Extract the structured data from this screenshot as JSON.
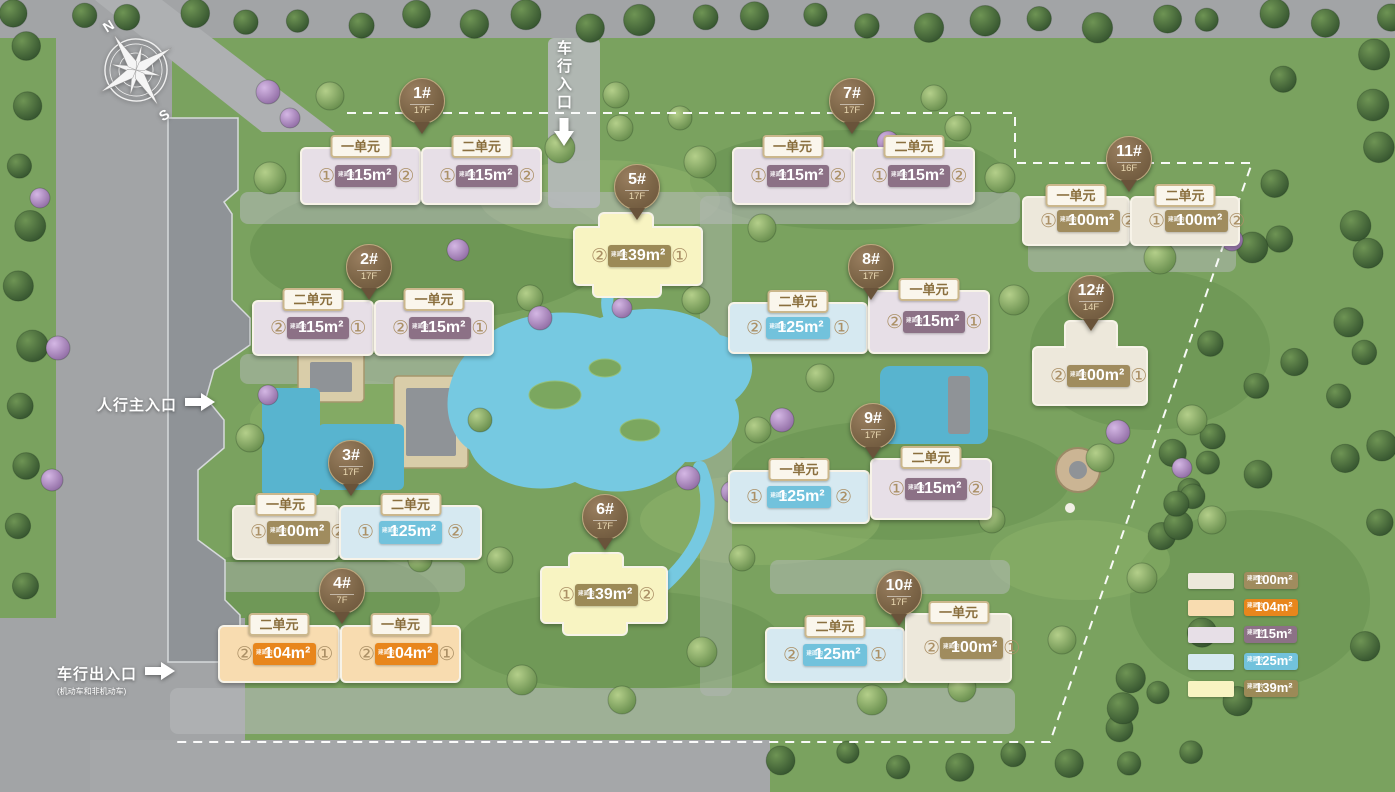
{
  "compass": {
    "north": "N",
    "south": "S"
  },
  "entrances": [
    {
      "id": "vehicle-entrance",
      "label": "车行入口",
      "sublabel": "",
      "orientation": "vertical",
      "arrow": "down",
      "x": 553,
      "y": 40
    },
    {
      "id": "pedestrian-main-entrance",
      "label": "人行主入口",
      "sublabel": "",
      "orientation": "horizontal",
      "arrow": "right",
      "x": 97,
      "y": 393
    },
    {
      "id": "vehicle-exit-entrance",
      "label": "车行出入口",
      "sublabel": "(机动车和非机动车)",
      "orientation": "horizontal",
      "arrow": "right",
      "x": 57,
      "y": 662
    }
  ],
  "area_prefix": "建面约",
  "area_types": {
    "100": {
      "fill": "#ede8db",
      "badge": "#a08c5e"
    },
    "104": {
      "fill": "#f8dcb0",
      "badge": "#e8861c"
    },
    "115": {
      "fill": "#e7dfe7",
      "badge": "#8c7186"
    },
    "125": {
      "fill": "#d6e9f1",
      "badge": "#72c2dc"
    },
    "139": {
      "fill": "#f8f4c2",
      "badge": "#9c8a57"
    }
  },
  "buildings": [
    {
      "name": "1#",
      "floors": "17F",
      "marker": {
        "x": 421,
        "y": 100
      },
      "units": [
        {
          "tag": "一单元",
          "left": "①",
          "right": "②",
          "area": "115m²",
          "type": "115",
          "x": 300,
          "y": 147,
          "w": 121,
          "h": 58
        },
        {
          "tag": "二单元",
          "left": "①",
          "right": "②",
          "area": "115m²",
          "type": "115",
          "x": 421,
          "y": 147,
          "w": 121,
          "h": 58
        }
      ]
    },
    {
      "name": "2#",
      "floors": "17F",
      "marker": {
        "x": 368,
        "y": 266
      },
      "units": [
        {
          "tag": "二单元",
          "left": "②",
          "right": "①",
          "area": "115m²",
          "type": "115",
          "x": 252,
          "y": 300,
          "w": 122,
          "h": 56
        },
        {
          "tag": "一单元",
          "left": "②",
          "right": "①",
          "area": "115m²",
          "type": "115",
          "x": 374,
          "y": 300,
          "w": 120,
          "h": 56
        }
      ]
    },
    {
      "name": "3#",
      "floors": "17F",
      "marker": {
        "x": 350,
        "y": 462
      },
      "units": [
        {
          "tag": "一单元",
          "left": "①",
          "right": "②",
          "area": "100m²",
          "type": "100",
          "x": 232,
          "y": 505,
          "w": 107,
          "h": 55
        },
        {
          "tag": "二单元",
          "left": "①",
          "right": "②",
          "area": "125m²",
          "type": "125",
          "x": 339,
          "y": 505,
          "w": 143,
          "h": 55
        }
      ]
    },
    {
      "name": "4#",
      "floors": "7F",
      "marker": {
        "x": 341,
        "y": 590
      },
      "units": [
        {
          "tag": "二单元",
          "left": "②",
          "right": "①",
          "area": "104m²",
          "type": "104",
          "x": 218,
          "y": 625,
          "w": 122,
          "h": 58
        },
        {
          "tag": "一单元",
          "left": "②",
          "right": "①",
          "area": "104m²",
          "type": "104",
          "x": 340,
          "y": 625,
          "w": 121,
          "h": 58
        }
      ]
    },
    {
      "name": "5#",
      "floors": "17F",
      "marker": {
        "x": 636,
        "y": 186
      },
      "units": [
        {
          "left": "②",
          "right": "①",
          "area": "139m²",
          "type": "139",
          "x": 573,
          "y": 226,
          "w": 130,
          "h": 60,
          "bumpTop": {
            "dx": 23,
            "w": 56,
            "h": 16
          },
          "bumpBottom": {
            "dx": 17,
            "w": 70,
            "h": 14
          }
        }
      ]
    },
    {
      "name": "6#",
      "floors": "17F",
      "marker": {
        "x": 604,
        "y": 516
      },
      "units": [
        {
          "left": "①",
          "right": "②",
          "area": "139m²",
          "type": "139",
          "x": 540,
          "y": 566,
          "w": 128,
          "h": 58,
          "bumpTop": {
            "dx": 26,
            "w": 56,
            "h": 16
          },
          "bumpBottom": {
            "dx": 20,
            "w": 66,
            "h": 14
          }
        }
      ]
    },
    {
      "name": "7#",
      "floors": "17F",
      "marker": {
        "x": 851,
        "y": 100
      },
      "units": [
        {
          "tag": "一单元",
          "left": "①",
          "right": "②",
          "area": "115m²",
          "type": "115",
          "x": 732,
          "y": 147,
          "w": 121,
          "h": 58
        },
        {
          "tag": "二单元",
          "left": "①",
          "right": "②",
          "area": "115m²",
          "type": "115",
          "x": 853,
          "y": 147,
          "w": 122,
          "h": 58
        }
      ]
    },
    {
      "name": "8#",
      "floors": "17F",
      "marker": {
        "x": 870,
        "y": 266
      },
      "units": [
        {
          "tag": "二单元",
          "left": "②",
          "right": "①",
          "area": "125m²",
          "type": "125",
          "x": 728,
          "y": 302,
          "w": 140,
          "h": 52
        },
        {
          "tag": "一单元",
          "left": "②",
          "right": "①",
          "area": "115m²",
          "type": "115",
          "x": 868,
          "y": 290,
          "w": 122,
          "h": 64
        }
      ]
    },
    {
      "name": "9#",
      "floors": "17F",
      "marker": {
        "x": 872,
        "y": 425
      },
      "units": [
        {
          "tag": "一单元",
          "left": "①",
          "right": "②",
          "area": "125m²",
          "type": "125",
          "x": 728,
          "y": 470,
          "w": 142,
          "h": 54
        },
        {
          "tag": "二单元",
          "left": "①",
          "right": "②",
          "area": "115m²",
          "type": "115",
          "x": 870,
          "y": 458,
          "w": 122,
          "h": 62
        }
      ]
    },
    {
      "name": "10#",
      "floors": "17F",
      "marker": {
        "x": 898,
        "y": 592
      },
      "units": [
        {
          "tag": "二单元",
          "left": "②",
          "right": "①",
          "area": "125m²",
          "type": "125",
          "x": 765,
          "y": 627,
          "w": 140,
          "h": 56
        },
        {
          "tag": "一单元",
          "left": "②",
          "right": "①",
          "area": "100m²",
          "type": "100",
          "x": 905,
          "y": 613,
          "w": 107,
          "h": 70
        }
      ]
    },
    {
      "name": "11#",
      "floors": "16F",
      "marker": {
        "x": 1128,
        "y": 158
      },
      "units": [
        {
          "tag": "一单元",
          "left": "①",
          "right": "②",
          "area": "100m²",
          "type": "100",
          "x": 1022,
          "y": 196,
          "w": 108,
          "h": 50
        },
        {
          "tag": "二单元",
          "left": "①",
          "right": "②",
          "area": "100m²",
          "type": "100",
          "x": 1130,
          "y": 196,
          "w": 110,
          "h": 50
        }
      ]
    },
    {
      "name": "12#",
      "floors": "14F",
      "marker": {
        "x": 1090,
        "y": 297
      },
      "units": [
        {
          "left": "②",
          "right": "①",
          "area": "100m²",
          "type": "100",
          "x": 1032,
          "y": 346,
          "w": 116,
          "h": 60,
          "bumpTop": {
            "dx": 30,
            "w": 54,
            "h": 28
          }
        }
      ]
    }
  ],
  "legend": {
    "items": [
      {
        "area": "100m²",
        "type": "100"
      },
      {
        "area": "104m²",
        "type": "104"
      },
      {
        "area": "115m²",
        "type": "115"
      },
      {
        "area": "125m²",
        "type": "125"
      },
      {
        "area": "139m²",
        "type": "139"
      }
    ]
  }
}
